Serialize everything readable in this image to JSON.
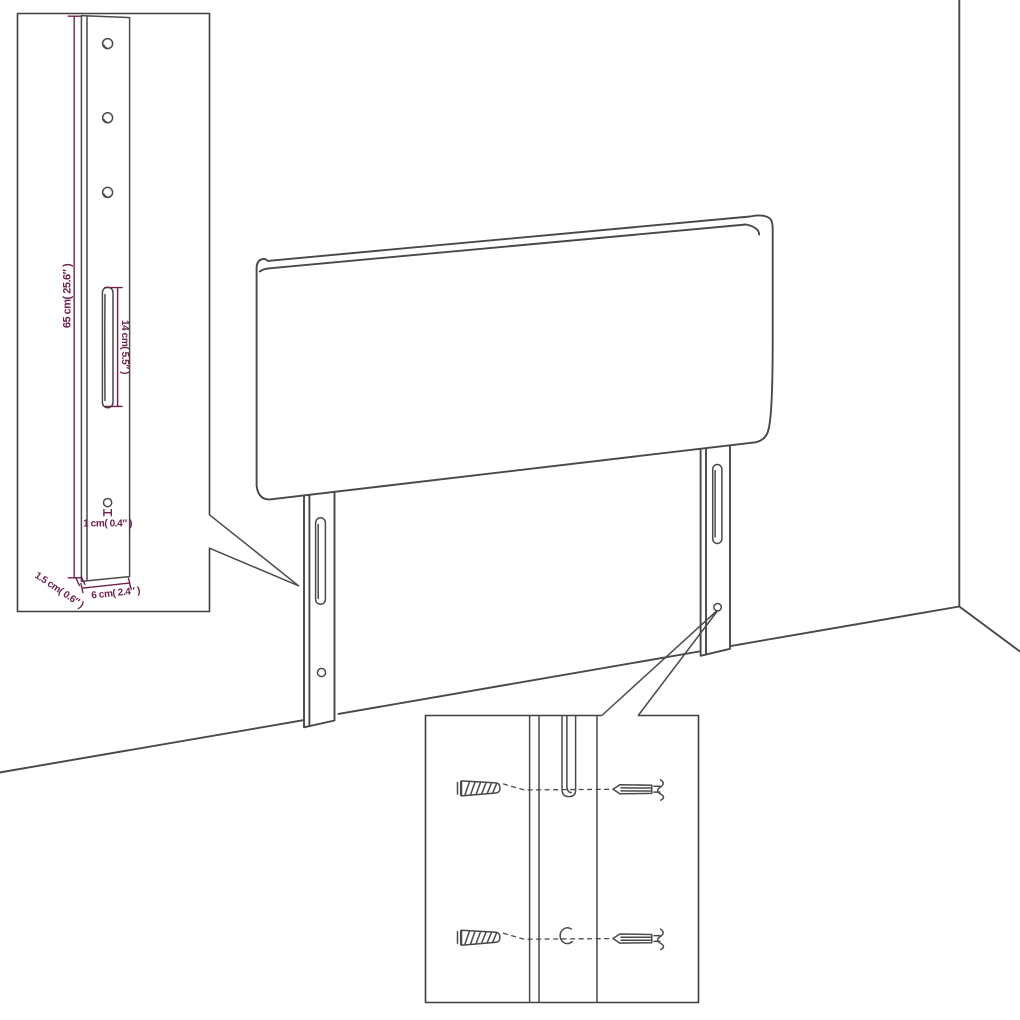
{
  "diagram": {
    "type": "furniture-assembly-dimension-diagram",
    "subject": "upholstered headboard with two mounting legs",
    "labels": {
      "height": "65 cm( 25.6″ )",
      "slot": "14 cm( 5.5″ )",
      "hole": "1 cm( 0.4″ )",
      "thickness": "1.5 cm( 0.6″ )",
      "width": "6 cm( 2.4″ )"
    },
    "colors": {
      "line": "#484848",
      "dimension_text": "#6e2150",
      "background": "#ffffff"
    }
  }
}
